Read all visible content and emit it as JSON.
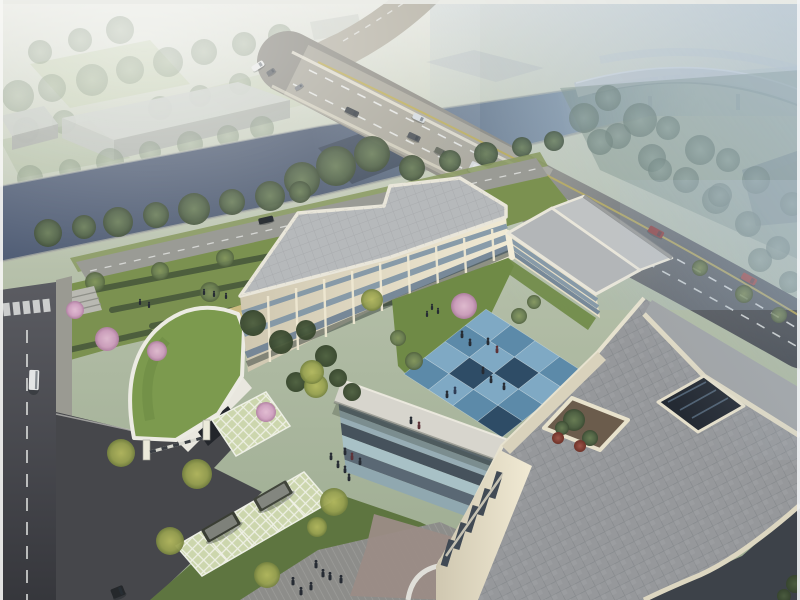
{
  "meta": {
    "type": "architectural-aerial-rendering",
    "description": "Bird's-eye rendering of a cream three-story U-shaped campus building with grey flat roofs, a blue checkerboard courtyard plaza, a curved green-roof gatehouse, grass-paver parking with two dark SUVs, a riverside arterial road crossing a canal bridge, and a hazy elevated flyover in the upper right."
  },
  "palette": {
    "haze_top": "#e3e5de",
    "forest": "#8a9a84",
    "river": "#4d5a70",
    "bridge_deck": "#b5b1a4",
    "road_dark": "#3f434a",
    "lane_white": "#eef0ee",
    "lane_yellow": "#c0ad4e",
    "roof_light": "#b6b9bb",
    "roof_big": "#96989b",
    "wall_cream": "#efe8d2",
    "window_band": "#7d93a5",
    "courtyard_light_blue": "#7fa9c4",
    "courtyard_mid_blue": "#5c8aa9",
    "courtyard_dark_blue": "#2e4c66",
    "grass": "#7b9150",
    "hedge": "#45563a",
    "blossom_pink": "#cf9fc0",
    "lattice": "#ccd6ad",
    "drive_asphalt": "#46474b",
    "street": "#53545a",
    "walk_grey": "#8d8d8a",
    "mauve_paving": "#9b8c86",
    "suv_dark": "#3a3e34",
    "red_car": "#8d2e2c",
    "flyover": "#c6cdd2",
    "water_haze": "#a9bcc8"
  },
  "scene": {
    "courtyard_tiles": {
      "origin": [
        404,
        374
      ],
      "u": [
        20.5,
        -16.2
      ],
      "v": [
        24.5,
        15.8
      ],
      "cols": 4,
      "rows": 4,
      "grid": [
        [
          "M",
          "L",
          "M",
          "L"
        ],
        [
          "L",
          "D",
          "L",
          "M"
        ],
        [
          "M",
          "L",
          "D",
          "L"
        ],
        [
          "D",
          "M",
          "L",
          "M"
        ]
      ],
      "palette": {
        "L": "#7fa9c4",
        "M": "#5c8aa9",
        "D": "#2e4c66"
      }
    },
    "plaza_stripes": {
      "o": [
        338,
        398
      ],
      "u": [
        168,
        62
      ],
      "v": [
        8,
        74
      ],
      "colors": [
        "#57656f",
        "#97adb5",
        "#46525c",
        "#a8c1c6",
        "#5a6874",
        "#90a8b0"
      ]
    },
    "hedges": {
      "items": [
        [
          84,
          292,
          322,
          246
        ],
        [
          112,
          310,
          354,
          262
        ],
        [
          152,
          326,
          394,
          278
        ],
        [
          198,
          342,
          430,
          294
        ],
        [
          60,
          352,
          150,
          332
        ]
      ]
    },
    "tree_groups": [
      {
        "name": "forest-tree",
        "layer": "forest",
        "grad": "gSage",
        "opacity": 0.45,
        "items": [
          [
            18,
            96,
            16
          ],
          [
            52,
            88,
            14
          ],
          [
            92,
            80,
            16
          ],
          [
            130,
            70,
            14
          ],
          [
            168,
            62,
            15
          ],
          [
            204,
            52,
            13
          ],
          [
            26,
            130,
            13
          ],
          [
            64,
            122,
            12
          ],
          [
            244,
            44,
            12
          ],
          [
            280,
            36,
            12
          ],
          [
            120,
            30,
            14
          ],
          [
            80,
            40,
            12
          ],
          [
            40,
            52,
            12
          ],
          [
            160,
            108,
            12
          ],
          [
            200,
            96,
            11
          ],
          [
            240,
            84,
            11
          ],
          [
            310,
            60,
            10
          ],
          [
            350,
            50,
            10
          ]
        ]
      },
      {
        "name": "far-bank-tree",
        "layer": "far-bank",
        "grad": "gSage",
        "opacity": 0.5,
        "items": [
          [
            30,
            178,
            13
          ],
          [
            70,
            170,
            11
          ],
          [
            110,
            162,
            14
          ],
          [
            150,
            152,
            11
          ],
          [
            190,
            144,
            13
          ],
          [
            228,
            136,
            11
          ],
          [
            262,
            128,
            12
          ]
        ]
      },
      {
        "name": "misty-tree",
        "layer": "road-east",
        "grad": "gSageB",
        "opacity": 0.7,
        "items": [
          [
            584,
            118,
            15
          ],
          [
            618,
            136,
            13
          ],
          [
            652,
            158,
            14
          ],
          [
            686,
            180,
            13
          ],
          [
            716,
            200,
            14
          ],
          [
            748,
            224,
            13
          ],
          [
            778,
            248,
            12
          ],
          [
            640,
            120,
            17
          ],
          [
            700,
            150,
            15
          ],
          [
            756,
            180,
            14
          ],
          [
            792,
            204,
            12
          ],
          [
            608,
            98,
            13
          ],
          [
            668,
            128,
            12
          ],
          [
            728,
            160,
            12
          ],
          [
            600,
            142,
            13
          ],
          [
            660,
            170,
            12
          ],
          [
            720,
            195,
            12
          ],
          [
            760,
            260,
            12
          ],
          [
            790,
            282,
            11
          ]
        ]
      },
      {
        "name": "riverside-tree",
        "layer": "riverside",
        "grad": "gDark",
        "opacity": 0.95,
        "items": [
          [
            48,
            233,
            14
          ],
          [
            84,
            227,
            12
          ],
          [
            118,
            222,
            15
          ],
          [
            156,
            215,
            13
          ],
          [
            194,
            209,
            16
          ],
          [
            232,
            202,
            13
          ],
          [
            270,
            196,
            15
          ],
          [
            302,
            180,
            18
          ],
          [
            336,
            166,
            20
          ],
          [
            372,
            154,
            18
          ],
          [
            300,
            192,
            11
          ],
          [
            412,
            168,
            13
          ],
          [
            450,
            161,
            11
          ],
          [
            486,
            154,
            12
          ],
          [
            522,
            147,
            10
          ],
          [
            554,
            141,
            10
          ]
        ]
      },
      {
        "name": "garden-tree",
        "layer": "garden-trees",
        "grad": "gMid",
        "opacity": 0.9,
        "items": [
          [
            95,
            282,
            10
          ],
          [
            160,
            271,
            9
          ],
          [
            225,
            258,
            9
          ],
          [
            290,
            246,
            9
          ],
          [
            355,
            232,
            9
          ],
          [
            420,
            220,
            9
          ],
          [
            62,
            300,
            9
          ],
          [
            352,
            252,
            13
          ],
          [
            210,
            292,
            10
          ]
        ]
      },
      {
        "name": "shrub",
        "layer": "site-front-trees",
        "grad": "gShrub",
        "opacity": 0.95,
        "items": [
          [
            253,
            323,
            13
          ],
          [
            281,
            342,
            12
          ],
          [
            306,
            330,
            10
          ],
          [
            326,
            356,
            11
          ],
          [
            338,
            378,
            9
          ],
          [
            296,
            382,
            10
          ],
          [
            352,
            392,
            9
          ]
        ]
      },
      {
        "name": "yellow-tree",
        "layer": "site-front-trees",
        "grad": "gYellow",
        "opacity": 0.95,
        "items": [
          [
            197,
            474,
            15
          ],
          [
            170,
            541,
            14
          ],
          [
            267,
            575,
            13
          ],
          [
            316,
            386,
            12
          ],
          [
            334,
            502,
            14
          ],
          [
            317,
            527,
            10
          ],
          [
            121,
            453,
            14
          ],
          [
            312,
            372,
            12
          ],
          [
            372,
            300,
            11
          ]
        ]
      },
      {
        "name": "courtyard-tree",
        "layer": "courtyard-trees",
        "grad": "gMid",
        "opacity": 0.95,
        "items": [
          [
            414,
            361,
            9
          ],
          [
            398,
            338,
            8
          ],
          [
            519,
            316,
            8
          ],
          [
            534,
            302,
            7
          ]
        ]
      },
      {
        "name": "blossom-tree",
        "layer": "site-front-trees",
        "grad": "gPink",
        "opacity": 0.95,
        "items": [
          [
            75,
            310,
            9
          ],
          [
            107,
            339,
            12
          ],
          [
            157,
            351,
            10
          ],
          [
            266,
            412,
            10
          ]
        ]
      },
      {
        "name": "blossom-tree",
        "layer": "courtyard-trees",
        "grad": "gPink",
        "opacity": 0.95,
        "items": [
          [
            464,
            306,
            13
          ]
        ]
      },
      {
        "name": "planter-tree",
        "layer": "planter-trees",
        "grad": "gDark",
        "opacity": 1,
        "items": [
          [
            574,
            420,
            11
          ],
          [
            590,
            438,
            8
          ],
          [
            562,
            428,
            7
          ]
        ]
      },
      {
        "name": "planter-red-shrub",
        "layer": "planter-trees",
        "grad": "gRed",
        "opacity": 1,
        "items": [
          [
            558,
            438,
            6
          ],
          [
            580,
            446,
            6
          ]
        ]
      },
      {
        "name": "verge-tree",
        "layer": "verge-trees",
        "grad": "gMid",
        "opacity": 0.8,
        "items": [
          [
            700,
            268,
            8
          ],
          [
            744,
            294,
            9
          ],
          [
            779,
            315,
            8
          ]
        ]
      },
      {
        "name": "corner-green",
        "layer": "corner-trees",
        "grad": "gShrub",
        "opacity": 0.9,
        "items": [
          [
            795,
            584,
            9
          ],
          [
            784,
            596,
            7
          ]
        ]
      }
    ],
    "vehicle_groups": [
      {
        "name": "road-vehicle",
        "layer": "veh-road",
        "items": [
          [
            352,
            112,
            14,
            6,
            25,
            "#383d43"
          ],
          [
            414,
            137,
            13,
            6,
            25,
            "#4a4f55"
          ],
          [
            441,
            152,
            13,
            6,
            26,
            "#5f6357"
          ],
          [
            419,
            118,
            13,
            6,
            25,
            "#d4dade"
          ],
          [
            483,
            172,
            29,
            11,
            26,
            "#dadcde"
          ],
          [
            656,
            232,
            16,
            7,
            28,
            "#8d2e2c"
          ],
          [
            749,
            279,
            16,
            7,
            29,
            "#9c3430"
          ]
        ]
      },
      {
        "name": "distant-vehicle",
        "layer": "veh-road",
        "items": [
          [
            258,
            66,
            13,
            6,
            -33,
            "#e7e8e6"
          ],
          [
            271,
            72,
            9,
            5,
            -33,
            "#595d61"
          ],
          [
            299,
            87,
            9,
            4,
            -33,
            "#7b7f84"
          ]
        ]
      },
      {
        "name": "frontage-vehicle",
        "layer": "veh-ground",
        "items": [
          [
            266,
            220,
            15,
            6,
            -13,
            "#2c3135"
          ]
        ]
      },
      {
        "name": "street-vehicle",
        "layer": "veh-ground",
        "items": [
          [
            34,
            380,
            10,
            20,
            2,
            "#e3e5e5"
          ],
          [
            118,
            592,
            13,
            10,
            -22,
            "#25282b"
          ]
        ]
      },
      {
        "name": "parked-suv",
        "layer": "veh-ground",
        "items": [
          [
            221,
            527,
            38,
            15,
            -30,
            "#3a3e34"
          ],
          [
            273,
            496,
            38,
            15,
            -30,
            "#41453b"
          ]
        ]
      }
    ],
    "people_groups": [
      {
        "name": "person",
        "layer": "people-top",
        "scale": 1,
        "items": [
          [
            488,
            344
          ],
          [
            497,
            352,
            "#5d3338"
          ],
          [
            483,
            373
          ],
          [
            491,
            382
          ],
          [
            504,
            389
          ],
          [
            455,
            393,
            "#2f3d55"
          ],
          [
            447,
            397
          ],
          [
            411,
            423
          ],
          [
            419,
            428,
            "#5d3338"
          ],
          [
            462,
            337
          ],
          [
            470,
            345
          ]
        ]
      },
      {
        "name": "person",
        "layer": "people-top",
        "scale": 0.8,
        "items": [
          [
            432,
            309
          ],
          [
            438,
            313
          ],
          [
            427,
            316
          ],
          [
            140,
            304
          ],
          [
            149,
            307
          ],
          [
            204,
            294
          ],
          [
            214,
            296
          ],
          [
            226,
            298
          ]
        ]
      },
      {
        "name": "person",
        "layer": "people-top",
        "scale": 1,
        "items": [
          [
            345,
            454
          ],
          [
            352,
            459,
            "#5d3338"
          ],
          [
            338,
            467
          ],
          [
            345,
            472
          ],
          [
            360,
            464
          ],
          [
            331,
            459
          ],
          [
            349,
            480
          ]
        ]
      },
      {
        "name": "person",
        "layer": "people-top",
        "scale": 1.1,
        "items": [
          [
            316,
            567
          ],
          [
            323,
            576
          ],
          [
            330,
            579
          ],
          [
            293,
            584
          ],
          [
            311,
            589
          ],
          [
            341,
            582
          ],
          [
            301,
            594
          ]
        ]
      }
    ]
  }
}
